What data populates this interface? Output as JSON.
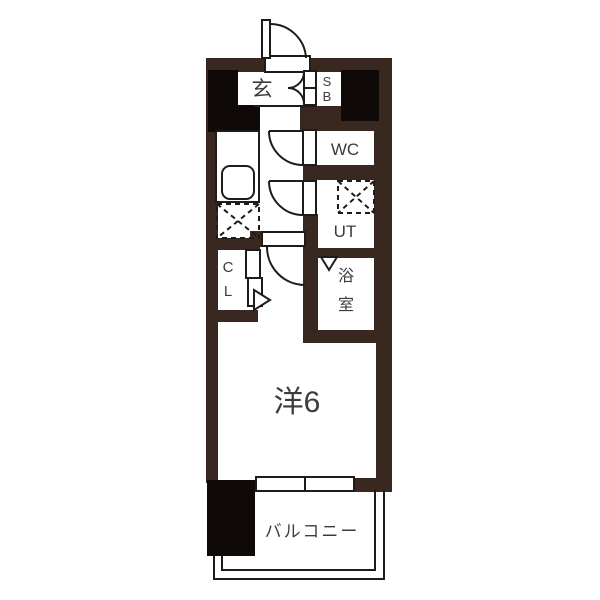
{
  "floorplan": {
    "type": "apartment-floor-plan",
    "labels": {
      "entrance": "玄",
      "shoebox_top": "S",
      "shoebox_bottom": "B",
      "toilet": "WC",
      "utility": "UT",
      "bath_top": "浴",
      "bath_bottom": "室",
      "closet_top": "C",
      "closet_bottom": "L",
      "western_room": "洋6",
      "balcony": "バルコニー"
    },
    "colors": {
      "wall": "#38281f",
      "block": "#0f0907",
      "line": "#1f1b19",
      "text": "#3c3c3c",
      "bg": "#ffffff"
    }
  }
}
